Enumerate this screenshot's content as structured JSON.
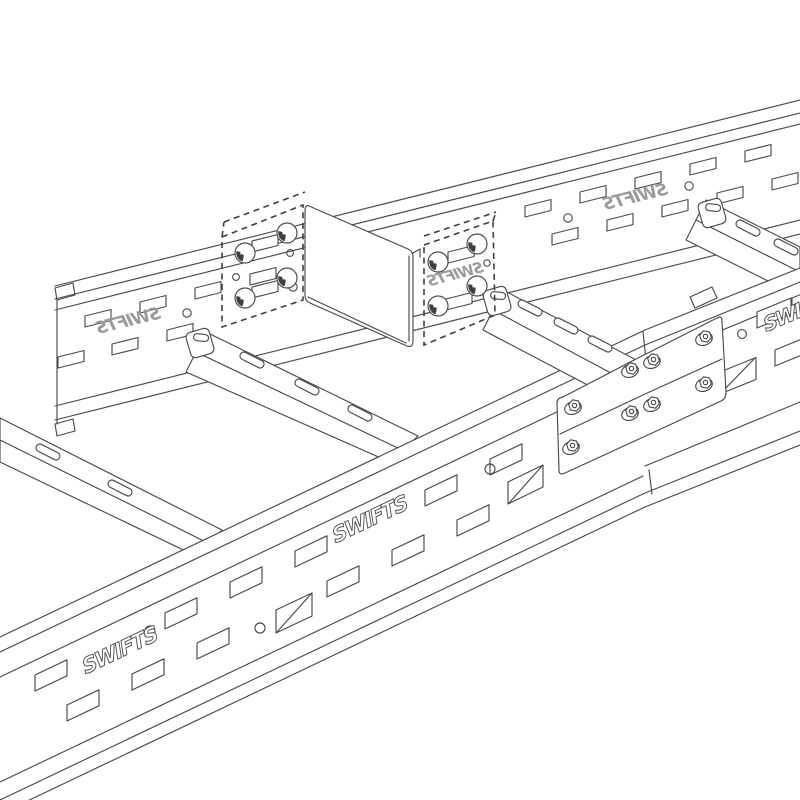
{
  "illustration": {
    "background_color": "#ffffff",
    "line_color": "#4a4a4a",
    "logo_gray_color": "#9b9b9b",
    "subject": "cable ladder sections joined with coupler plates and bolted splice",
    "components": {
      "far_side_rail": "perforated side rail",
      "near_side_rail": "perforated side rail",
      "rungs_visible": 4,
      "coupler_bolt_heads": 8,
      "splice_hex_bolts": 8,
      "large_cutouts": 3
    }
  },
  "brand": {
    "name": "SWIFTS"
  },
  "logos": {
    "far_rail_left": {
      "text": "SWIFTS",
      "mirrored": true
    },
    "far_rail_right": {
      "text": "SWIFTS",
      "mirrored": true
    },
    "coupler_plate": {
      "text": "SWIFTS",
      "mirrored": true
    },
    "near_rail_left": {
      "text": "SWIFTS",
      "mirrored": false
    },
    "near_rail_mid": {
      "text": "SWIFTS",
      "mirrored": false
    },
    "near_rail_right_partial": {
      "text": "SWIFTS",
      "mirrored": false
    }
  }
}
